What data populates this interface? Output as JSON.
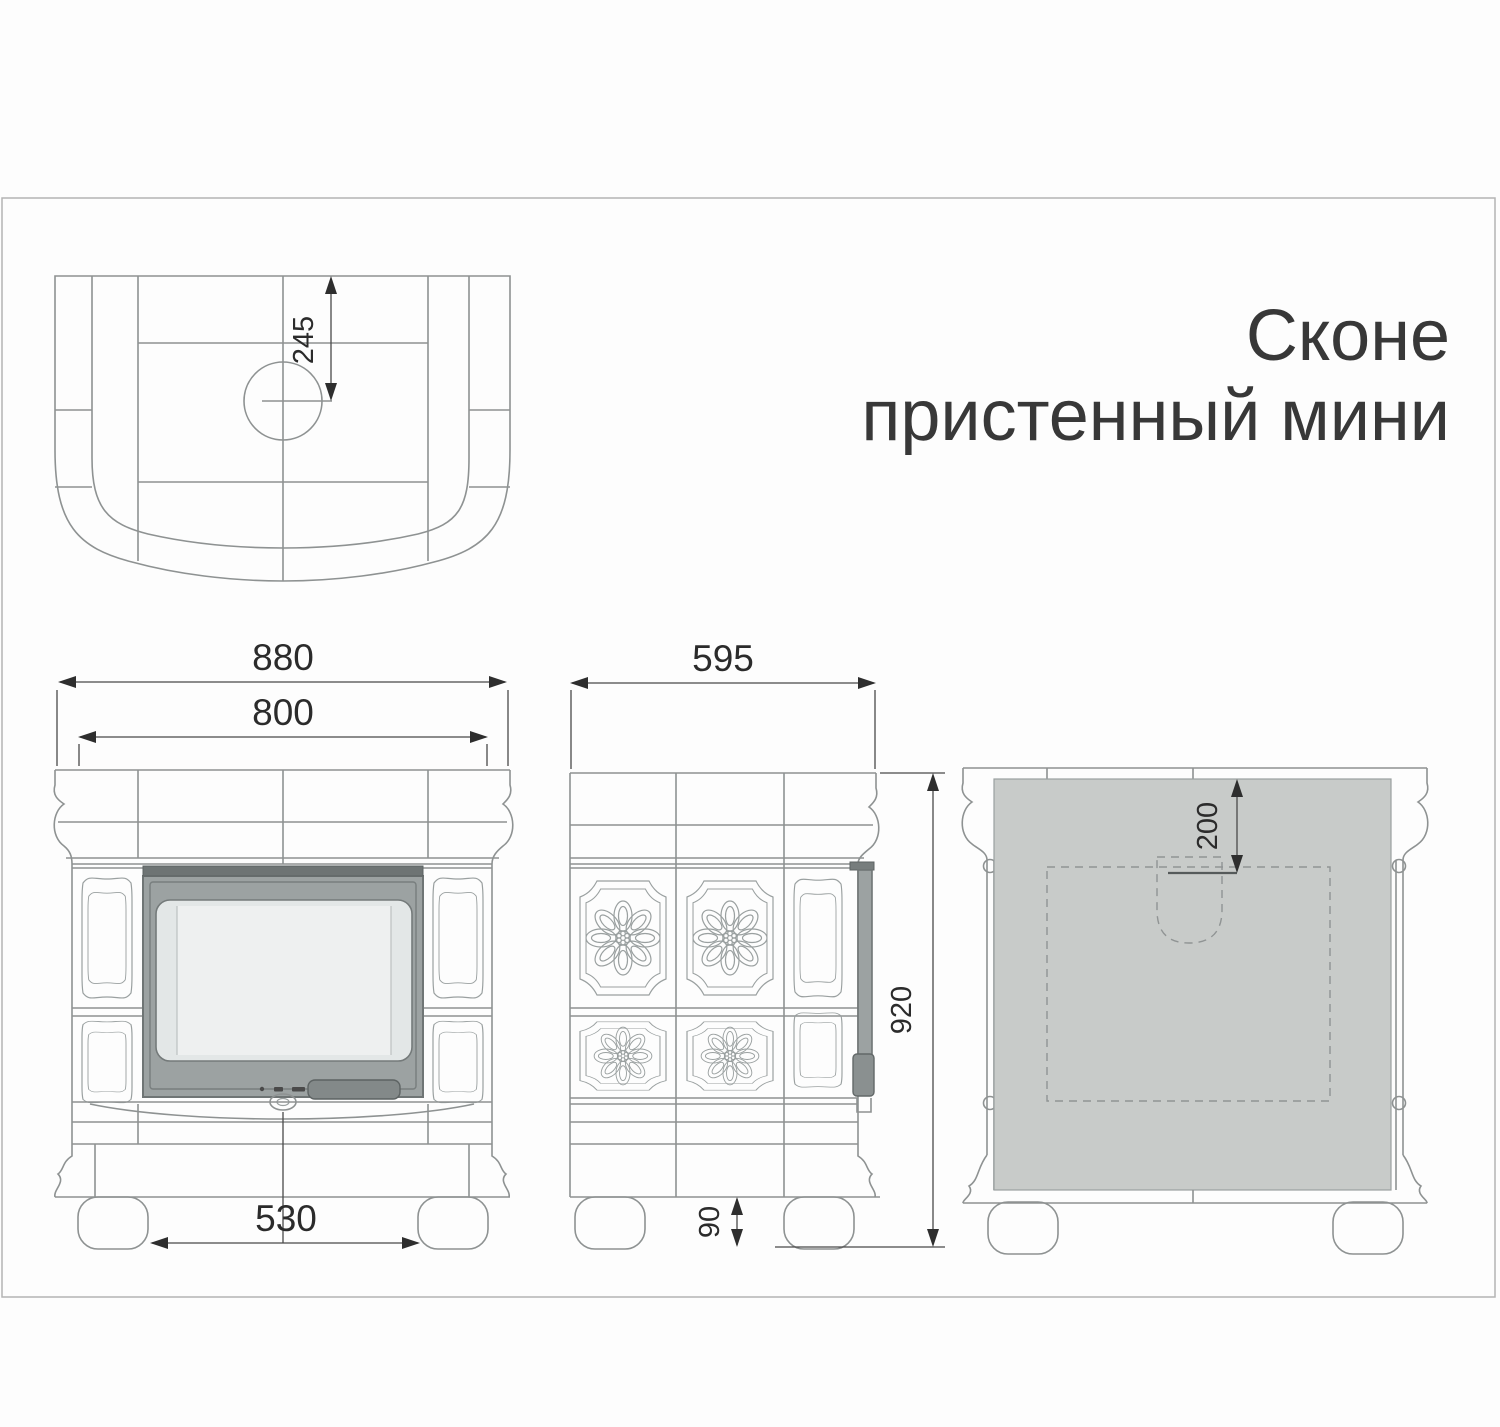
{
  "title": {
    "line1": "Сконе",
    "line2": "пристенный мини"
  },
  "dimensions": {
    "top_view": {
      "flue_center_offset_mm": "245"
    },
    "front_view": {
      "overall_width_mm": "880",
      "body_width_mm": "800",
      "feet_inner_span_mm": "530"
    },
    "side_view": {
      "depth_mm": "595",
      "overall_height_mm": "920",
      "foot_height_mm": "90"
    },
    "back_view": {
      "flue_offset_from_top_mm": "200"
    }
  },
  "colors": {
    "back_panel_gray": "#c8cbc9",
    "door_frame_gray": "#9ca2a2",
    "door_top_strip": "#6e7474",
    "glass_gray": "#e3e7e7",
    "handle_gray": "#838989",
    "line_gray": "#8e9292",
    "dimension_dark": "#2e2e2e",
    "frame_border": "#b4b4b4"
  }
}
